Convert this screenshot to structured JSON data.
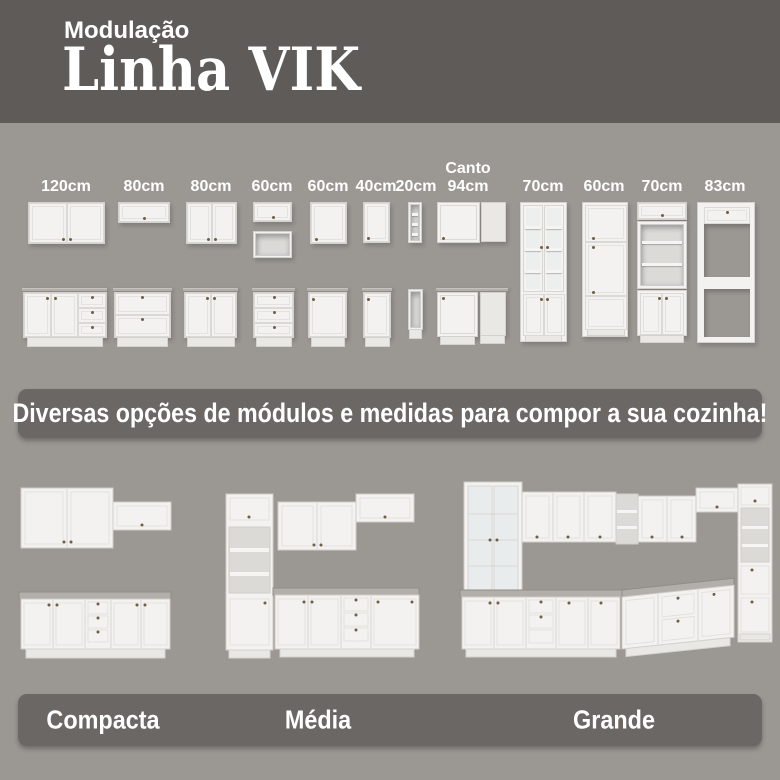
{
  "header": {
    "kicker": "Modulação",
    "title": "Linha VIK"
  },
  "modules": {
    "items": [
      {
        "label": "120cm"
      },
      {
        "label": "80cm"
      },
      {
        "label": "80cm"
      },
      {
        "label": "60cm"
      },
      {
        "label": "60cm"
      },
      {
        "label": "40cm"
      },
      {
        "label": "20cm"
      },
      {
        "label": "Canto",
        "label2": "94cm"
      },
      {
        "label": "70cm"
      },
      {
        "label": "60cm"
      },
      {
        "label": "70cm"
      },
      {
        "label": "83cm"
      }
    ]
  },
  "banner": {
    "text": "Diversas opções de módulos e medidas para compor a sua cozinha!"
  },
  "kitchens": {
    "items": [
      {
        "label": "Compacta"
      },
      {
        "label": "Média"
      },
      {
        "label": "Grande"
      }
    ]
  },
  "colors": {
    "header_bg": "#5e5b58",
    "body_bg": "#9b9793",
    "panel_bg": "#6b6764",
    "cabinet_white": "#f3f2f0",
    "countertop": "#b2afab",
    "text": "#ffffff"
  }
}
